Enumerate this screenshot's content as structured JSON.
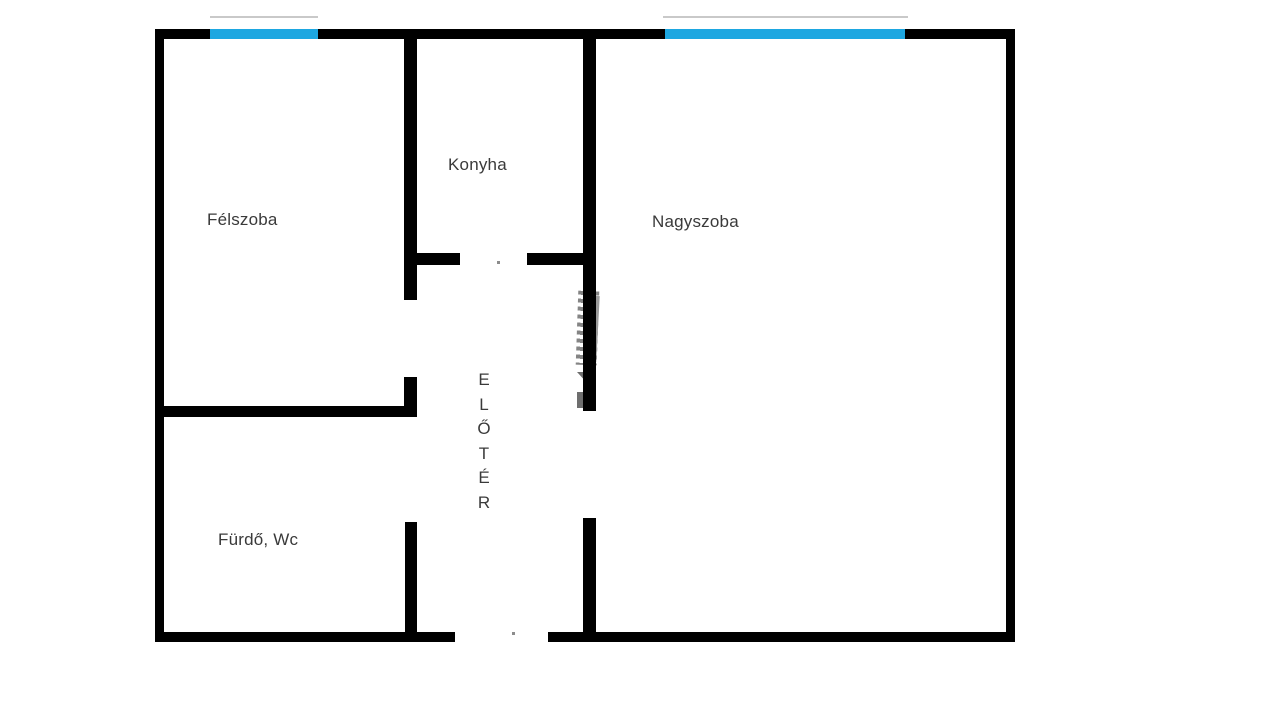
{
  "title": "Floor plan",
  "floorplan": {
    "rooms": [
      {
        "name": "felszoba",
        "label": "Félszoba"
      },
      {
        "name": "konyha",
        "label": "Konyha"
      },
      {
        "name": "nagyszoba",
        "label": "Nagyszoba"
      },
      {
        "name": "furdo-wc",
        "label": "Fürdő, Wc"
      },
      {
        "name": "eloter",
        "label": "ELŐTÉR",
        "letters": [
          "E",
          "L",
          "Ő",
          "T",
          "É",
          "R"
        ]
      }
    ],
    "windows": [
      {
        "name": "felszoba-window"
      },
      {
        "name": "nagyszoba-window"
      }
    ],
    "colors": {
      "wall": "#000000",
      "window_fill": "#1da7e1",
      "window_outer_line": "#c9c9c9",
      "text": "#3a3a3a",
      "door_dot": "#8c8c8c",
      "watermark": "#6e6e6e",
      "background": "#ffffff"
    }
  }
}
